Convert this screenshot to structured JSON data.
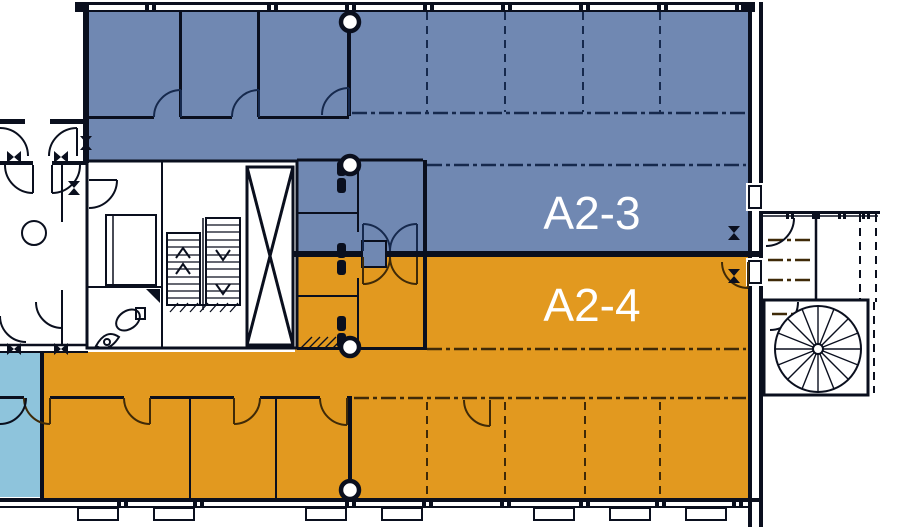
{
  "plan": {
    "type": "architectural-floor-plan",
    "zones": [
      {
        "label": "A2-3",
        "color": "#7088b2",
        "text_color": "#ffffff",
        "position": "upper"
      },
      {
        "label": "A2-4",
        "color": "#e2991f",
        "text_color": "#ffffff",
        "position": "lower"
      }
    ],
    "accent_zone": {
      "name": "small-room-left",
      "color": "#8ec4dc"
    },
    "wall_color": "#0a0f1e",
    "background": "#ffffff",
    "line_colors": {
      "dashdot_on_blue": "#16294d",
      "dashdot_on_orange": "#3f2a08"
    },
    "features": [
      "double-run-staircase",
      "elevator-shaft-x-brace",
      "spiral-staircase",
      "wc-fixtures",
      "door-swings",
      "structural-columns",
      "window-mullions",
      "corridor-dashdot-boundaries",
      "dashed-partition-lines",
      "zone-divider-wall"
    ]
  }
}
